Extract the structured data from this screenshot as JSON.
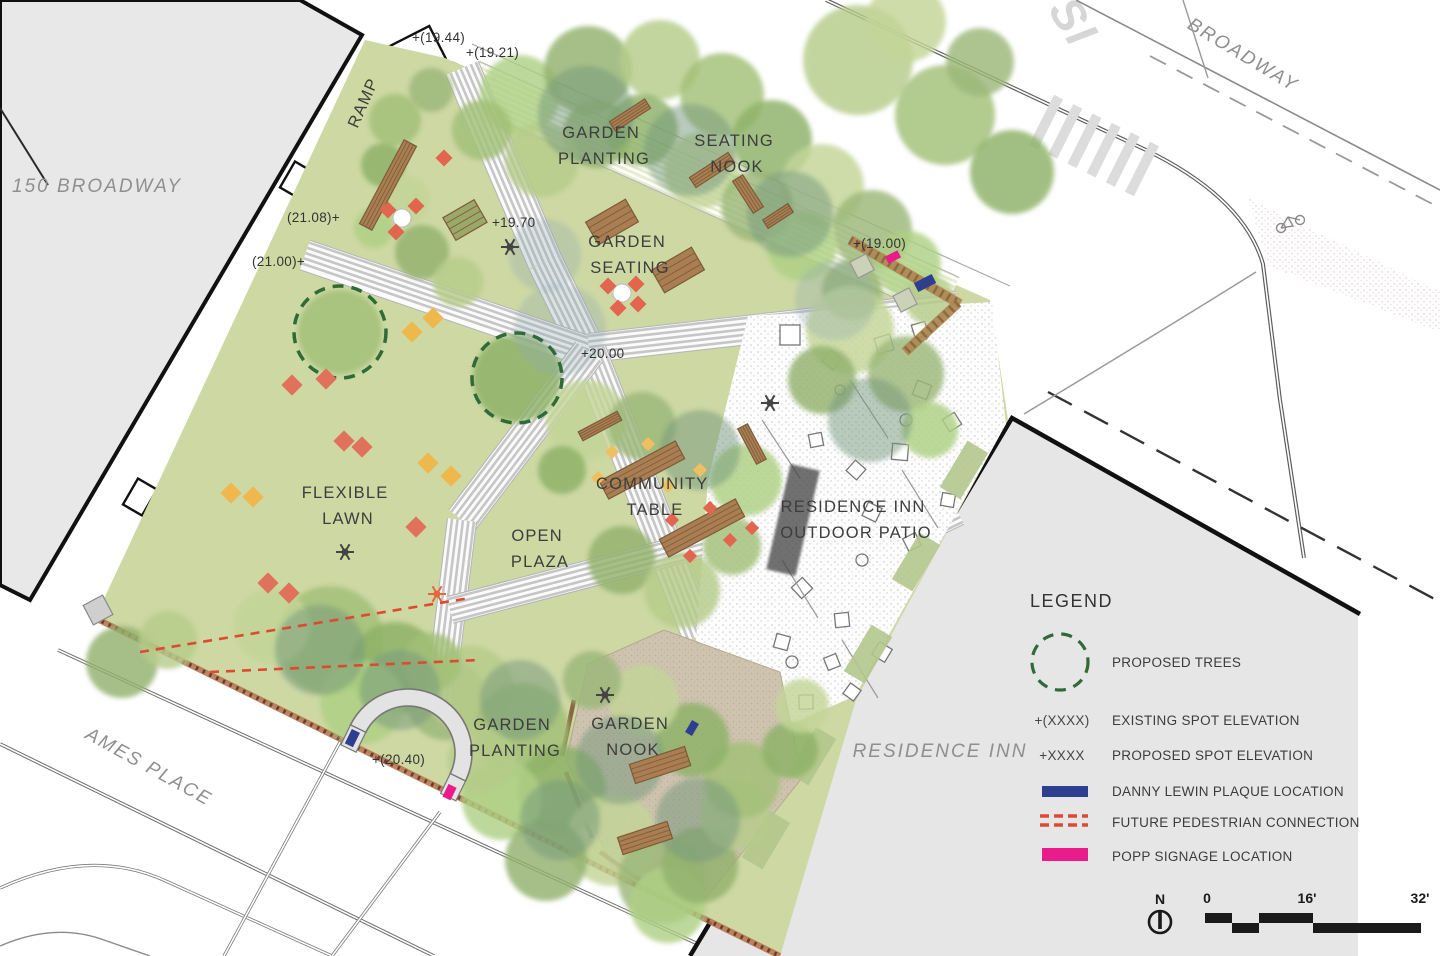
{
  "colors": {
    "plaque_navy": "#2e3f8f",
    "signage_pink": "#ea1c8c",
    "pedestrian_red": "#dd4a30",
    "proposed_tree_green": "#2f6b36",
    "lawn_green": "#cdd8a3",
    "path_stripe_gray": "#c6c6c6",
    "boundary_brown": "#b5714f"
  },
  "streets": {
    "broadway": "BROADWAY",
    "ames_place": "AMES PLACE",
    "partial_sign": "SI"
  },
  "buildings": {
    "broadway_150": "150 BROADWAY",
    "residence_inn": "RESIDENCE INN"
  },
  "areas": {
    "ramp": "RAMP",
    "garden_planting_top": {
      "line1": "GARDEN",
      "line2": "PLANTING"
    },
    "seating_nook": {
      "line1": "SEATING",
      "line2": "NOOK"
    },
    "garden_seating": {
      "line1": "GARDEN",
      "line2": "SEATING"
    },
    "flexible_lawn": {
      "line1": "FLEXIBLE",
      "line2": "LAWN"
    },
    "open_plaza": {
      "line1": "OPEN",
      "line2": "PLAZA"
    },
    "community_table": {
      "line1": "COMMUNITY",
      "line2": "TABLE"
    },
    "outdoor_patio": {
      "line1": "RESIDENCE INN",
      "line2": "OUTDOOR PATIO"
    },
    "garden_planting_bottom": {
      "line1": "GARDEN",
      "line2": "PLANTING"
    },
    "garden_nook": {
      "line1": "GARDEN",
      "line2": "NOOK"
    }
  },
  "elevations": {
    "e1944": "+(19.44)",
    "e1921": "+(19.21)",
    "e2108": "(21.08)+",
    "e2100": "(21.00)+",
    "e1970": "+19.70",
    "e2000": "+20.00",
    "e1900": "+(19.00)",
    "e2040": "+(20.40)"
  },
  "legend": {
    "title": "LEGEND",
    "proposed_trees": "PROPOSED TREES",
    "existing_symbol": "+(XXXX)",
    "existing_label": "EXISTING SPOT ELEVATION",
    "proposed_symbol": "+XXXX",
    "proposed_label": "PROPOSED SPOT ELEVATION",
    "plaque_label": "DANNY LEWIN PLAQUE LOCATION",
    "pedestrian_label": "FUTURE PEDESTRIAN CONNECTION",
    "signage_label": "POPP SIGNAGE LOCATION"
  },
  "scale_bar": {
    "north_label": "N",
    "tick_zero": "0",
    "tick_mid": "16'",
    "tick_end": "32'"
  }
}
